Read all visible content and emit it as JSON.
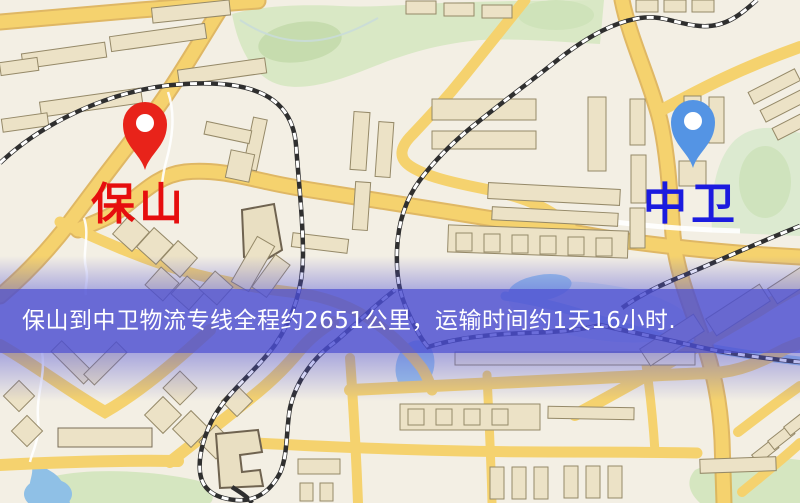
{
  "map": {
    "origin": {
      "label": "保山",
      "pin_color": "#e8231a",
      "label_color": "#e60e0e"
    },
    "destination": {
      "label": "中卫",
      "pin_color": "#5494e4",
      "label_color": "#1b1bdf"
    },
    "banner": {
      "text": "保山到中卫物流专线全程约2651公里，运输时间约1天16小时.",
      "background": "#4b4dd2",
      "text_color": "#ffffff"
    },
    "colors": {
      "background": "#f3efe4",
      "road": "#f5d26e",
      "road_casing": "#dcae4e",
      "water": "#9ec7e8",
      "park": "#d9e8c5",
      "building": "#ece2c6",
      "railway": "#2f2f2f"
    }
  }
}
